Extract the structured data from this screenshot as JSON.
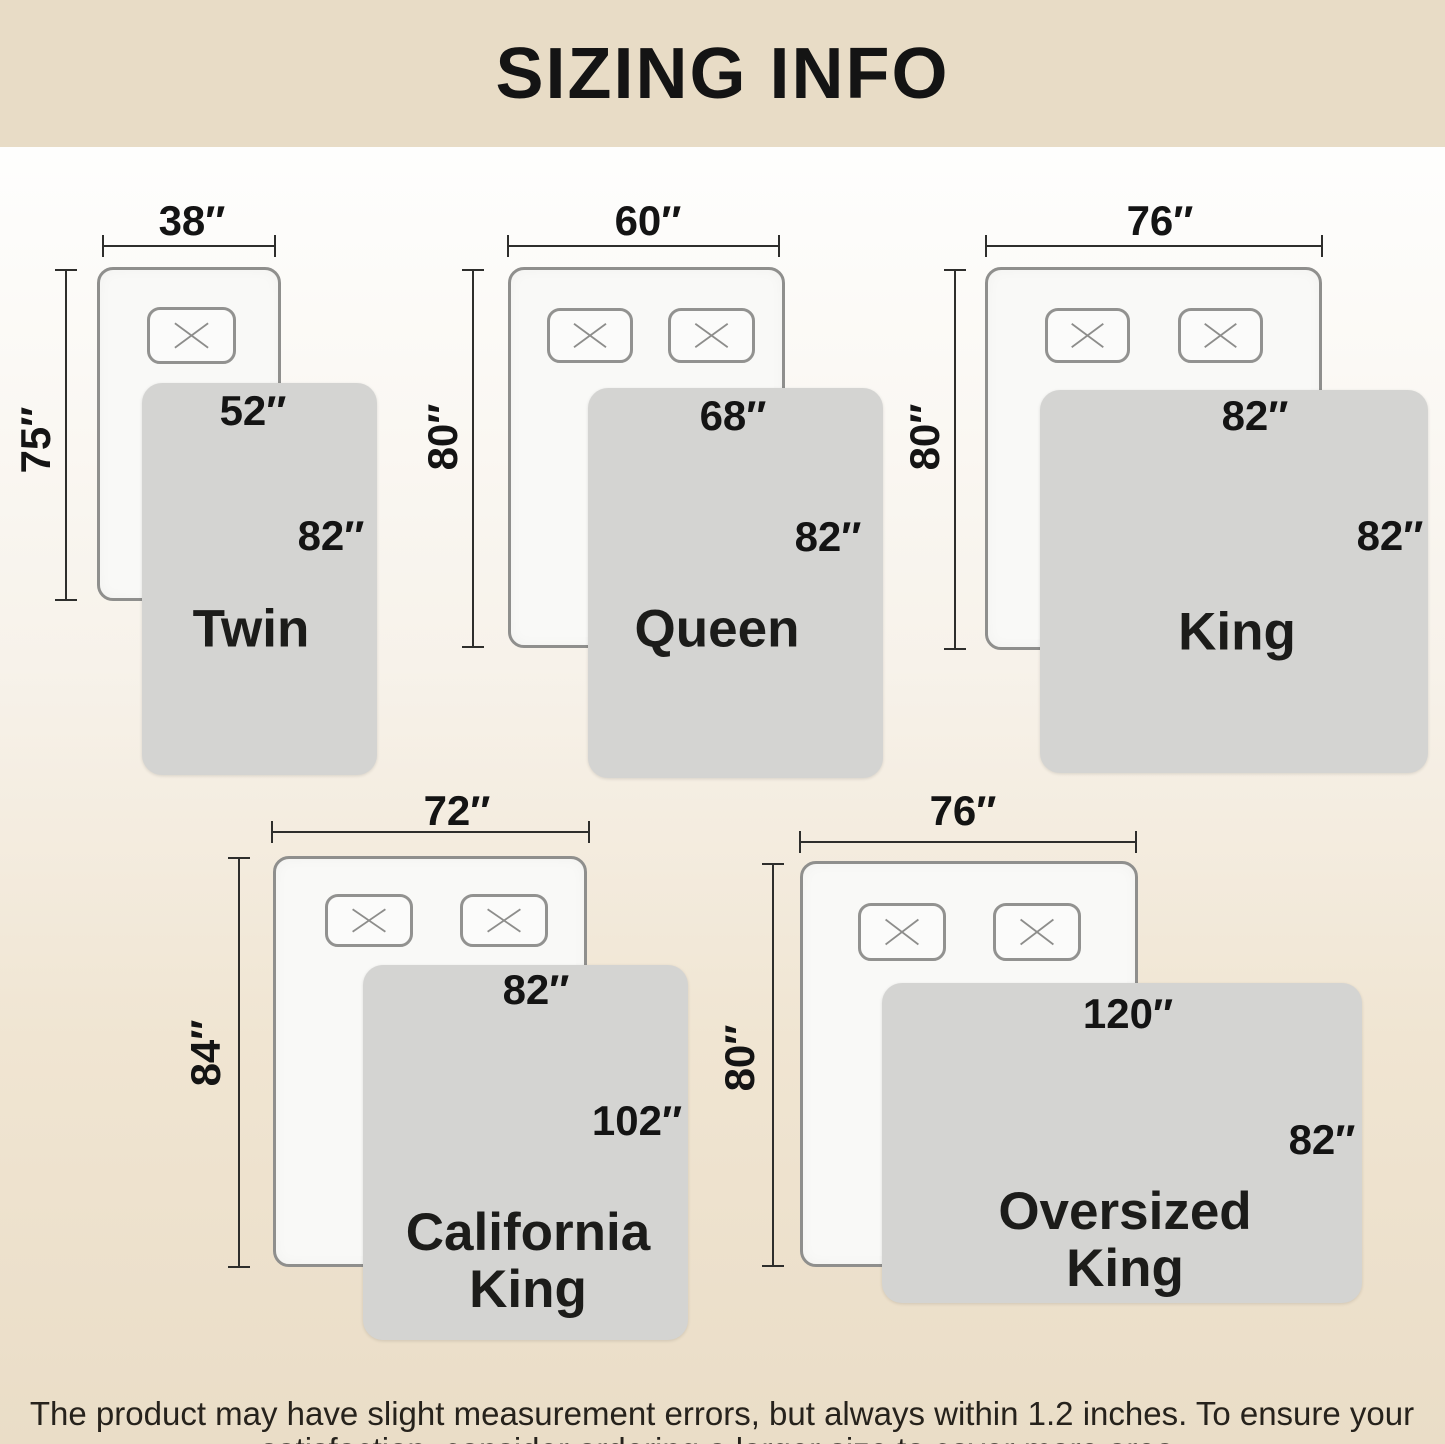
{
  "title": "SIZING INFO",
  "footnote": {
    "line1": "The product may have slight measurement errors, but always within 1.2 inches. To ensure your",
    "line2": "satisfaction, consider ordering a larger size to cover more area."
  },
  "colors": {
    "header_bg": "#e8dcc6",
    "page_top": "#fefefd",
    "page_bottom": "#eaddc7",
    "bed_fill": "#f9f9f7",
    "bed_border": "#8f8f8d",
    "blanket_fill": "#d4d4d2",
    "dim_line": "#2e2e2c",
    "text": "#141414"
  },
  "sizes": [
    {
      "name": "Twin",
      "name_line1": "Twin",
      "name_line2": "",
      "bed_width": "38″",
      "bed_length": "75″",
      "blanket_width": "52″",
      "blanket_length": "82″"
    },
    {
      "name": "Queen",
      "name_line1": "Queen",
      "name_line2": "",
      "bed_width": "60″",
      "bed_length": "80″",
      "blanket_width": "68″",
      "blanket_length": "82″"
    },
    {
      "name": "King",
      "name_line1": "King",
      "name_line2": "",
      "bed_width": "76″",
      "bed_length": "80″",
      "blanket_width": "82″",
      "blanket_length": "82″"
    },
    {
      "name": "California King",
      "name_line1": "California",
      "name_line2": "King",
      "bed_width": "72″",
      "bed_length": "84″",
      "blanket_width": "82″",
      "blanket_length": "102″"
    },
    {
      "name": "Oversized King",
      "name_line1": "Oversized",
      "name_line2": "King",
      "bed_width": "76″",
      "bed_length": "80″",
      "blanket_width": "120″",
      "blanket_length": "82″"
    }
  ]
}
